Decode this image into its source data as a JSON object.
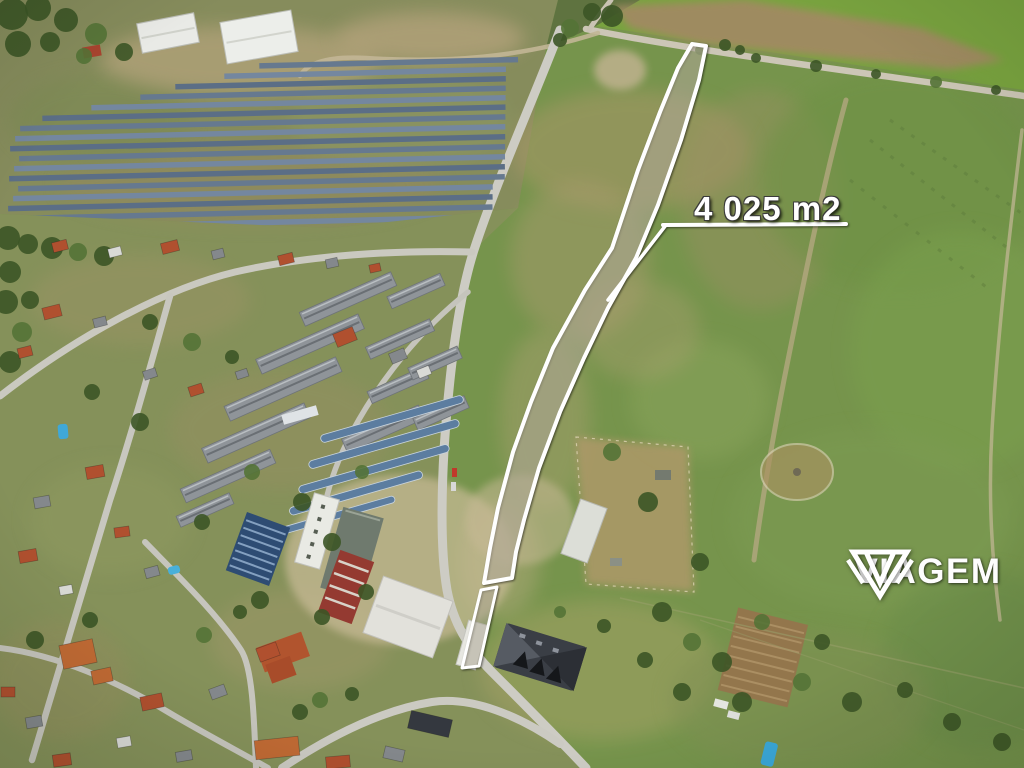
{
  "annotation": {
    "area_label": "4 025 m2"
  },
  "branding": {
    "logo_text": "VIAGEM",
    "logo_icon": "gem-icon"
  },
  "colors": {
    "annotation_white": "#ffffff",
    "plot_outline": "#ffffff"
  }
}
